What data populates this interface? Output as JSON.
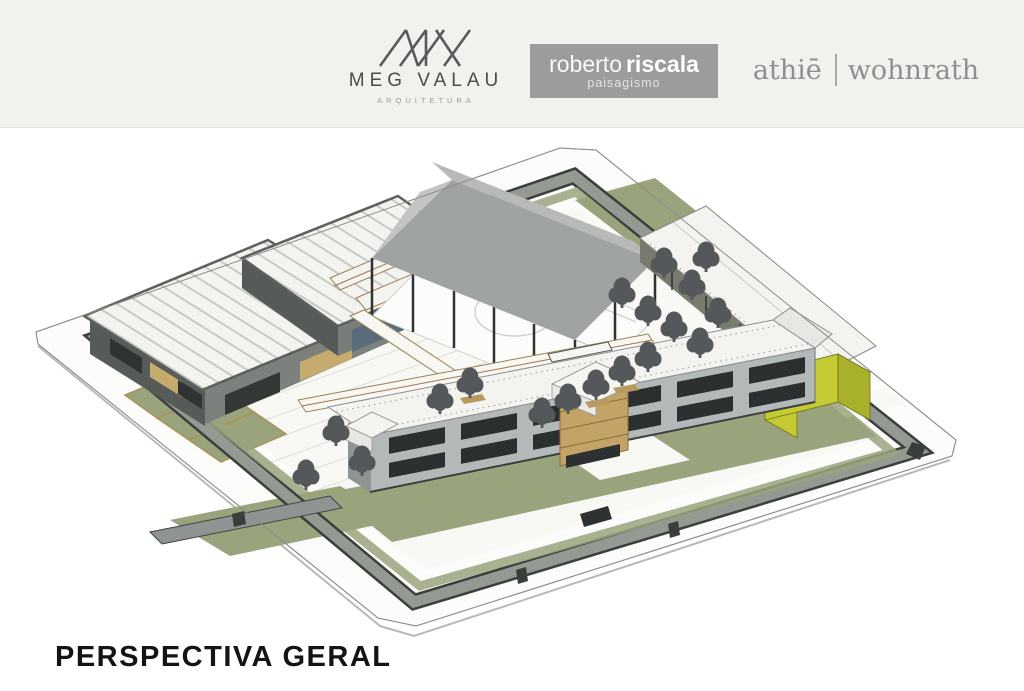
{
  "header": {
    "logos": {
      "meg_valau": {
        "name": "MEG VALAU",
        "subtitle": "ARQUITETURA"
      },
      "roberto_riscala": {
        "name_light": "roberto",
        "name_bold": "riscala",
        "subtitle": "paisagismo"
      },
      "athie_wohnrath": {
        "left": "athiē",
        "right": "wohnrath"
      }
    }
  },
  "caption": {
    "title": "PERSPECTIVA GERAL"
  },
  "illustration": {
    "type": "architectural-3d-axonometric-rendering",
    "description": "Aerial axonometric perspective of a walled school campus: two ribbed-white-roof pavilions on the left, a large grey gabled sports canopy on steel columns in the centre, a long white gallery building along the upper-right edge, a chartreuse-yellow service box on the right, a long two-storey classroom building with dark ribbon windows and a timber entrance volume in front, olive-green lawns and stepped planters, dark grey trees, covered walkways with timber trim, all surrounded by a grey perimeter wall on a white plinth.",
    "elements": [
      "perimeter wall",
      "lawns",
      "ribbed roof pavilions",
      "sports canopy",
      "gallery building",
      "yellow service box",
      "classroom building",
      "timber entrance",
      "trees",
      "stepped planters",
      "covered walkways"
    ]
  },
  "theme": {
    "header_bg": "#f2f1ee",
    "logo_dark": "#4c4c4c",
    "logo_sub": "#9a9a9a",
    "riscala_bg": "#9c9c9c",
    "athie_gray": "#8f8f8f",
    "caption_color": "#141414",
    "plinth": "#fcfcfa",
    "plaza": "#f8f8f5",
    "wall_gray": "#949a92",
    "wall_dark": "#3b3f3c",
    "lawn": "#9aa47c",
    "roof_white": "#f3f3f0",
    "rib_line": "#c9c9c5",
    "canopy_gray": "#9fa3a2",
    "canopy_light": "#b7bab8",
    "facade_gray": "#b3b8b8",
    "window_dark": "#2c2f30",
    "dark_frame": "#565b57",
    "tree": "#54585b",
    "wood": "#c3a366",
    "walk_trim": "#a5734a",
    "accent_front": "#c4ca31",
    "accent_top": "#d9da60",
    "accent_side": "#a9b02a"
  }
}
